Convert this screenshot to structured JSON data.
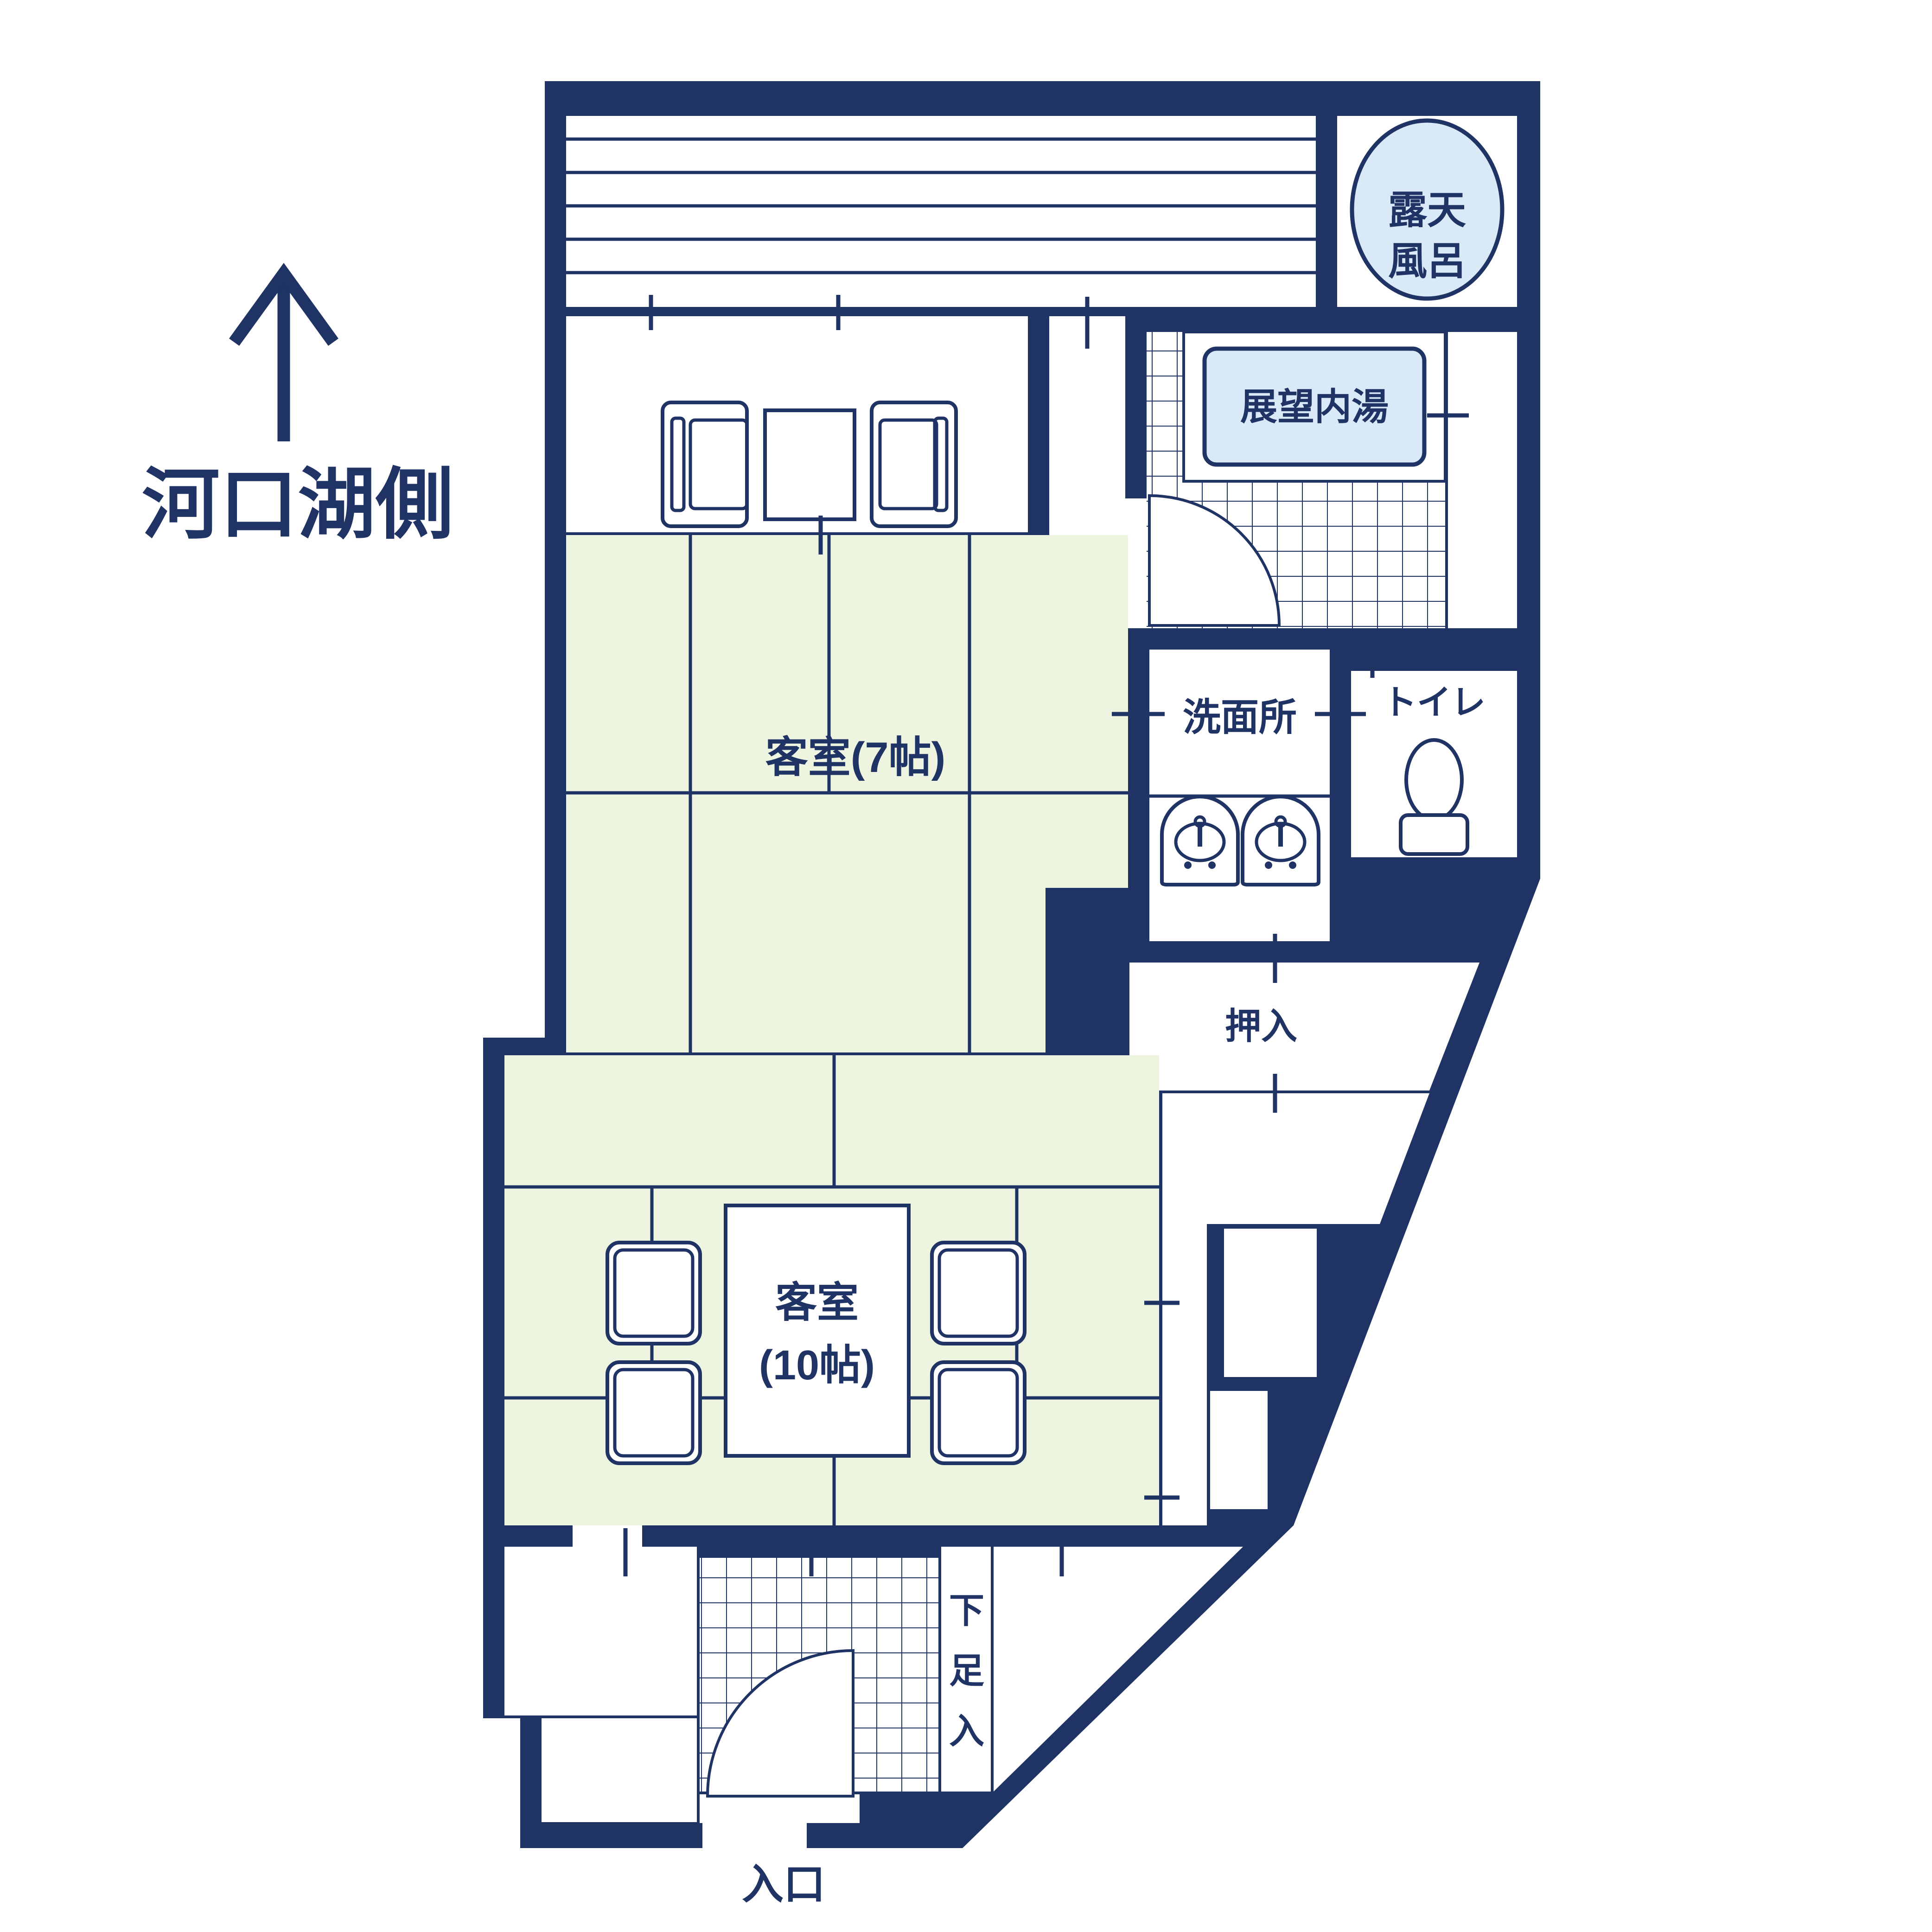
{
  "palette": {
    "navy": "#1F3365",
    "tatami": "#EDF5E1",
    "water": "#DAE9F8",
    "paper": "#FFFFFF"
  },
  "compass": {
    "label": "河口湖側"
  },
  "rooms": {
    "rotenburo": {
      "line1": "露天",
      "line2": "風呂"
    },
    "indoor_bath": {
      "label": "展望内湯"
    },
    "guest7": {
      "label": "客室(7帖)"
    },
    "washroom": {
      "label": "洗面所"
    },
    "toilet": {
      "label": "トイレ"
    },
    "closet": {
      "label": "押入"
    },
    "guest10": {
      "line1": "客室",
      "line2": "(10帖)"
    },
    "shoe": {
      "c0": "下",
      "c1": "足",
      "c2": "入"
    },
    "entrance": {
      "label": "入口"
    }
  }
}
